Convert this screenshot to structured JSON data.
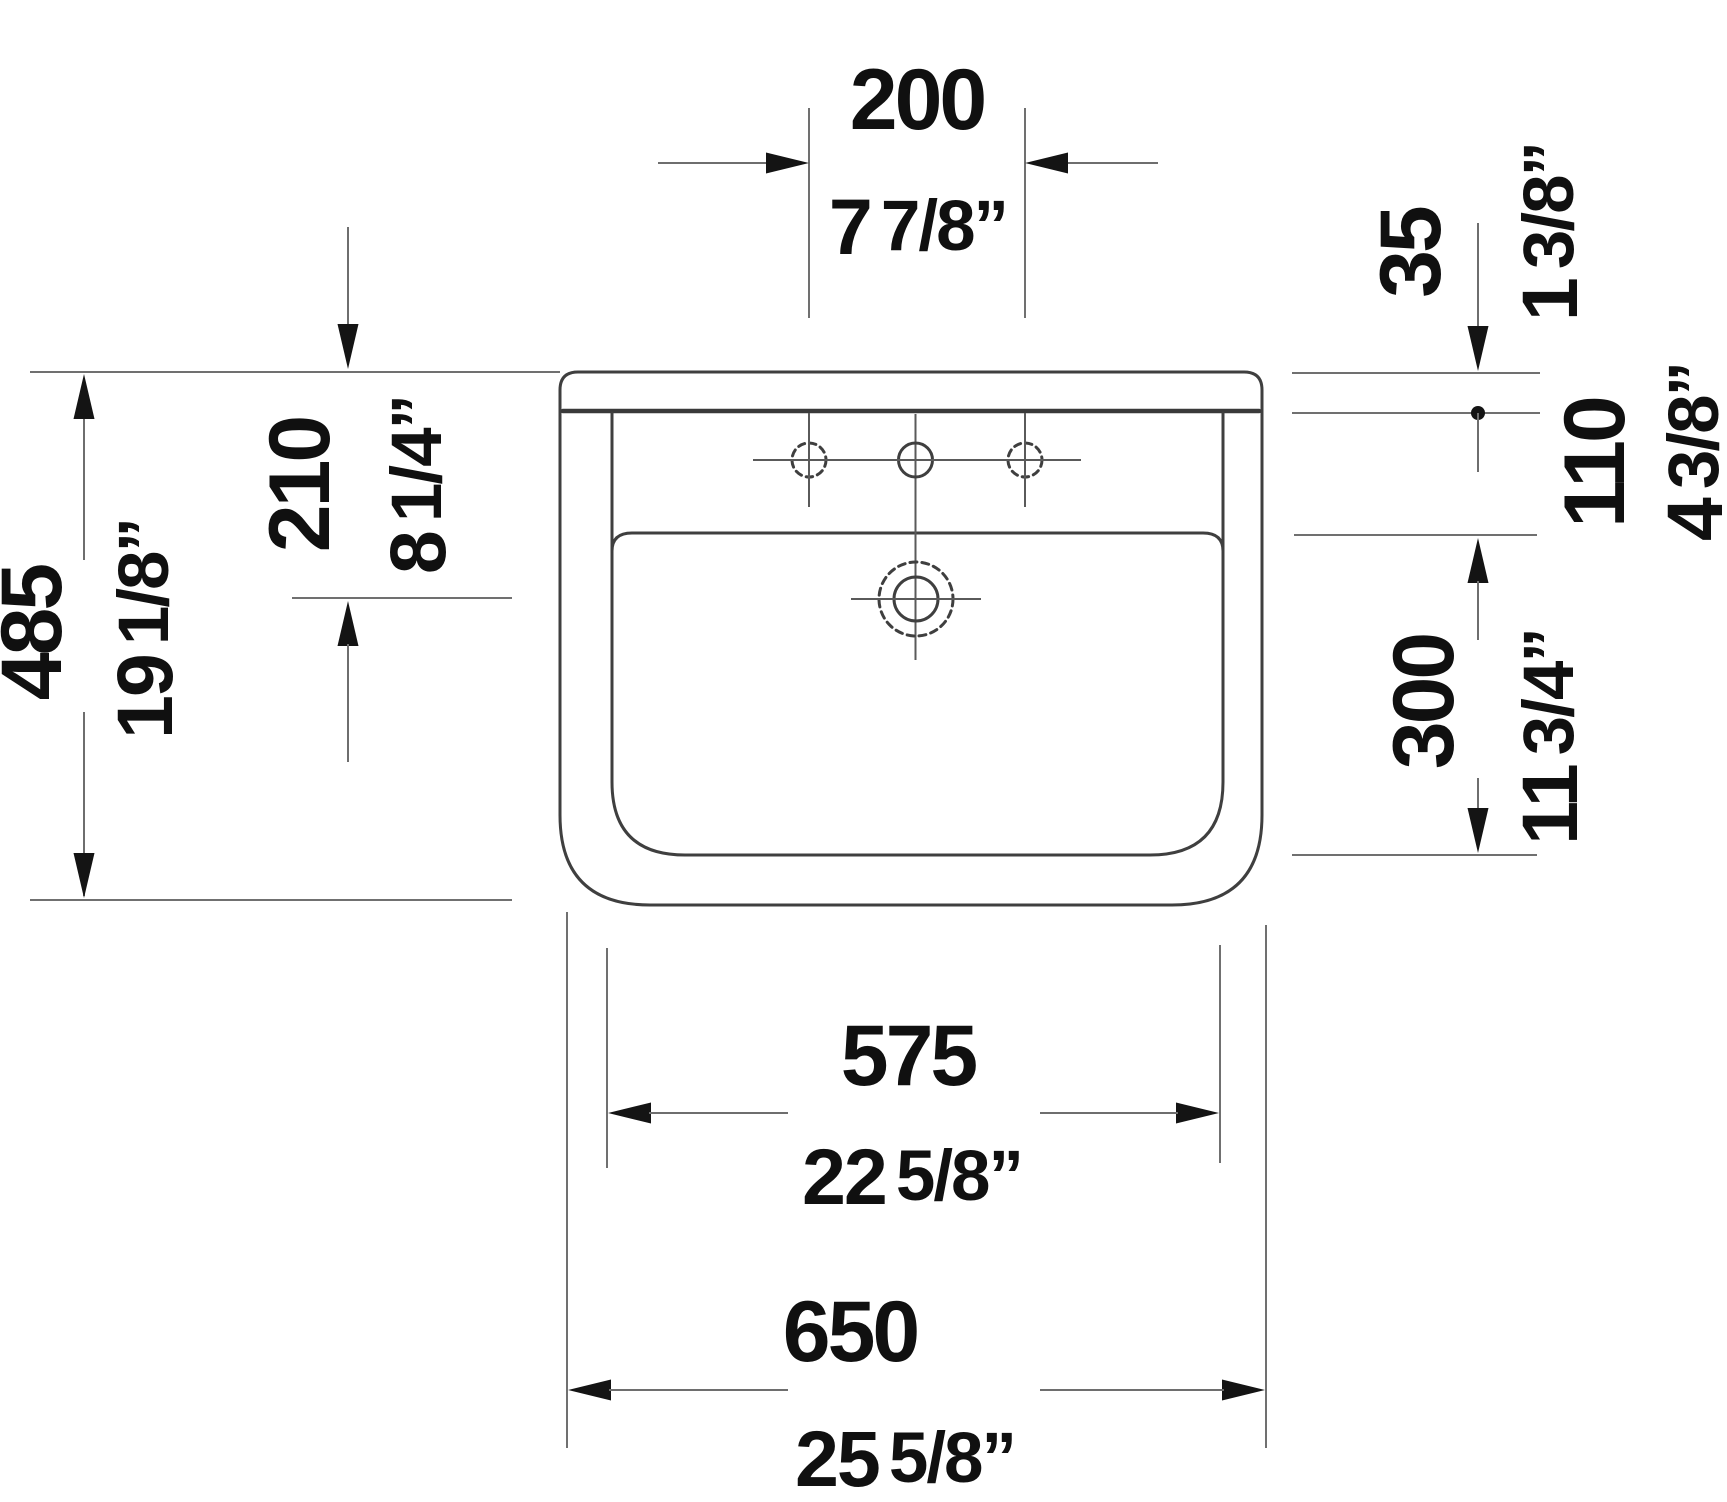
{
  "drawing": {
    "type": "washbasin-front-elevation-technical-drawing",
    "units_shown": [
      "mm",
      "inches"
    ],
    "line_color": "#3f3f3f",
    "dimension_color": "#6e6e6e",
    "text_color": "#101010",
    "dimensions": {
      "faucet_hole_spacing": {
        "mm": "200",
        "inch_whole": "7",
        "inch_frac": "7/8”"
      },
      "rim_thickness": {
        "mm": "35",
        "inch_whole": "1",
        "inch_frac": "3/8”"
      },
      "rim_to_bowl_edge": {
        "mm": "110",
        "inch_whole": "4",
        "inch_frac": "3/8”"
      },
      "bowl_inner_depth": {
        "mm": "300",
        "inch_whole": "11",
        "inch_frac": "3/4”"
      },
      "overall_height": {
        "mm": "485",
        "inch_whole": "19",
        "inch_frac": "1/8”"
      },
      "top_to_overflow": {
        "mm": "210",
        "inch_whole": "8",
        "inch_frac": "1/4”"
      },
      "bowl_inner_width": {
        "mm": "575",
        "inch_whole": "22",
        "inch_frac": "5/8”"
      },
      "overall_width": {
        "mm": "650",
        "inch_whole": "25",
        "inch_frac": "5/8”"
      }
    }
  }
}
